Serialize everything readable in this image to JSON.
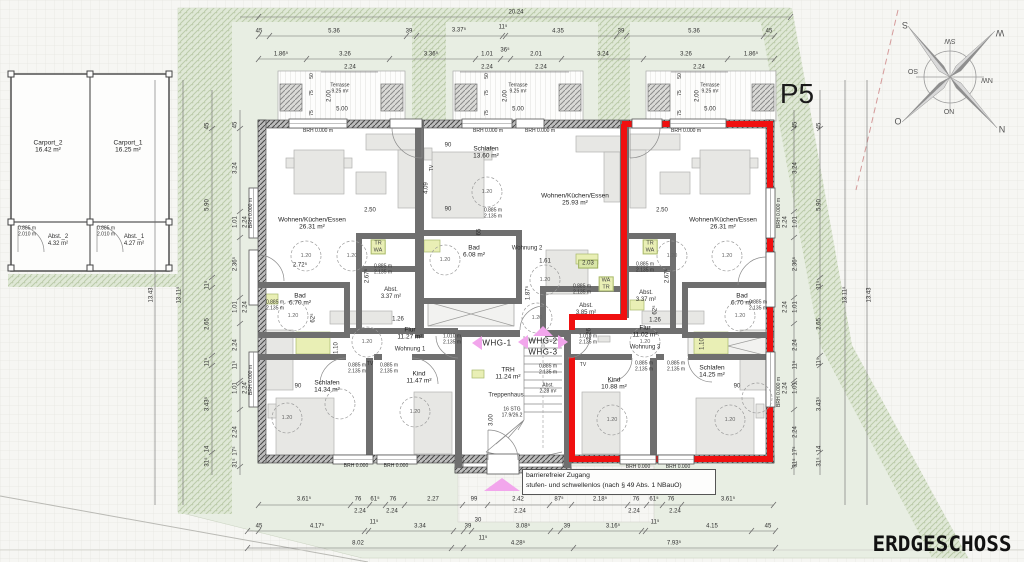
{
  "plan": {
    "p5": "P5",
    "title": "ERDGESCHOSS"
  },
  "note": {
    "l1": "barrierefreier Zugang",
    "l2": "stufen- und schwellenlos (nach § 49 Abs. 1 NBauO)"
  },
  "compass": {
    "n": "N",
    "e": "O",
    "s": "S",
    "w": "W",
    "ne": "NO",
    "se": "SO",
    "sw": "SW",
    "nw": "NW"
  },
  "carports": {
    "c2": "Carport_2",
    "c2a": "16.42 m²",
    "c1": "Carport_1",
    "c1a": "16.25 m²",
    "a2": "Abst._2",
    "a2a": "4.32 m²",
    "a1": "Abst._1",
    "a1a": "4.27 m²",
    "dw": "0.885 m",
    "dh": "2.010 m"
  },
  "units": {
    "whg1": "WHG-1",
    "whg2": "WHG-2",
    "whg3": "WHG-3",
    "w1": "Wohnung 1",
    "w2": "Wohnung 2",
    "w3": "Wohnung 3"
  },
  "rooms": {
    "w1_live": {
      "n": "Wohnen/Küchen/Essen",
      "a": "26.31 m²"
    },
    "w1_bad": {
      "n": "Bad",
      "a": "6.70 m²"
    },
    "w1_schlafen": {
      "n": "Schlafen",
      "a": "14.34 m²"
    },
    "w1_kind": {
      "n": "Kind",
      "a": "11.47 m²"
    },
    "w1_flur": {
      "n": "Flur",
      "a": "11.27 m²"
    },
    "w1_abst": {
      "n": "Abst.",
      "a": "3.37 m²"
    },
    "w2_live": {
      "n": "Wohnen/Küchen/Essen",
      "a": "25.93 m²"
    },
    "w2_schlafen": {
      "n": "Schlafen",
      "a": "13.60 m²"
    },
    "w2_bad": {
      "n": "Bad",
      "a": "6.08 m²"
    },
    "w2_abst": {
      "n": "Abst.",
      "a": "3.85 m²"
    },
    "w3_live": {
      "n": "Wohnen/Küchen/Essen",
      "a": "26.31 m²"
    },
    "w3_bad": {
      "n": "Bad",
      "a": "6.70 m²"
    },
    "w3_schlafen": {
      "n": "Schlafen",
      "a": "14.25 m²"
    },
    "w3_kind": {
      "n": "Kind",
      "a": "10.88 m²"
    },
    "w3_flur": {
      "n": "Flur",
      "a": "11.02 m²"
    },
    "w3_abst": {
      "n": "Abst.",
      "a": "3.37 m²"
    }
  },
  "stair": {
    "trh": "TRH",
    "trh_a": "11.24 m²",
    "name": "Treppenhaus",
    "stg": "16 STG",
    "stg2": "17.9/26.2",
    "abst": "Abst.",
    "abst_a": "2.28 m²"
  },
  "terrace": {
    "name": "Terrasse",
    "area": "9.25 m²",
    "d50": "50",
    "d75": "75",
    "h": "2.00",
    "w": "5.00"
  },
  "labels": {
    "brh": "BRH 0.000 m",
    "brhs": "BRH 0.000",
    "dw": "0.885 m",
    "dh": "2.135 m",
    "d2w": "1.010 m",
    "d2h": "2.135 m",
    "tr": "TR",
    "wa": "WA",
    "tv": "TV",
    "d90": "90",
    "circ": "1.20",
    "elev": "2.03"
  },
  "dims": {
    "top_total": "20.24",
    "top_a": [
      "45",
      "5.36",
      "39",
      "3.37⁵",
      "11⁵",
      "4.35",
      "39",
      "5.36",
      "45"
    ],
    "top_b": [
      "1.86⁵",
      "3.26",
      "3.36⁵",
      "1.01",
      "36⁵",
      "2.01",
      "3.24",
      "3.26",
      "1.86⁵"
    ],
    "w224": "2.24",
    "bot_a": [
      "3.61⁵",
      "76",
      "61⁵",
      "76",
      "2.27",
      "99",
      "2.42",
      "87⁵",
      "2.18⁵",
      "76",
      "61⁵",
      "76",
      "3.61⁵"
    ],
    "bot_b": [
      "45",
      "4.17⁵",
      "11⁵",
      "3.34",
      "39",
      "30",
      "3.08⁵",
      "39",
      "3.16⁵",
      "11⁵",
      "4.15",
      "45"
    ],
    "bot_c": [
      "8.02",
      "11⁵",
      "4.28⁵",
      "7.93⁵"
    ],
    "left_a": [
      "45",
      "5.90",
      "11⁵",
      "2.65",
      "11⁵",
      "3.43⁵",
      "14",
      "31⁵"
    ],
    "left_b": [
      "45",
      "3.24",
      "1.01",
      "2.36⁵",
      "1.01",
      "2.24",
      "11⁵",
      "1.01",
      "2.24",
      "17⁵",
      "31⁵"
    ],
    "t1": "13.43",
    "t2": "13.11⁵",
    "i": {
      "a250": "2.50",
      "a272": "2.72⁵",
      "a267": "2.67⁵",
      "a409": "4.09",
      "a65": "65",
      "a161": "1.61",
      "a187": "1.87⁵",
      "a300": "3.00",
      "a126": "1.26",
      "a110": "1.10",
      "a62": "62⁵"
    }
  }
}
